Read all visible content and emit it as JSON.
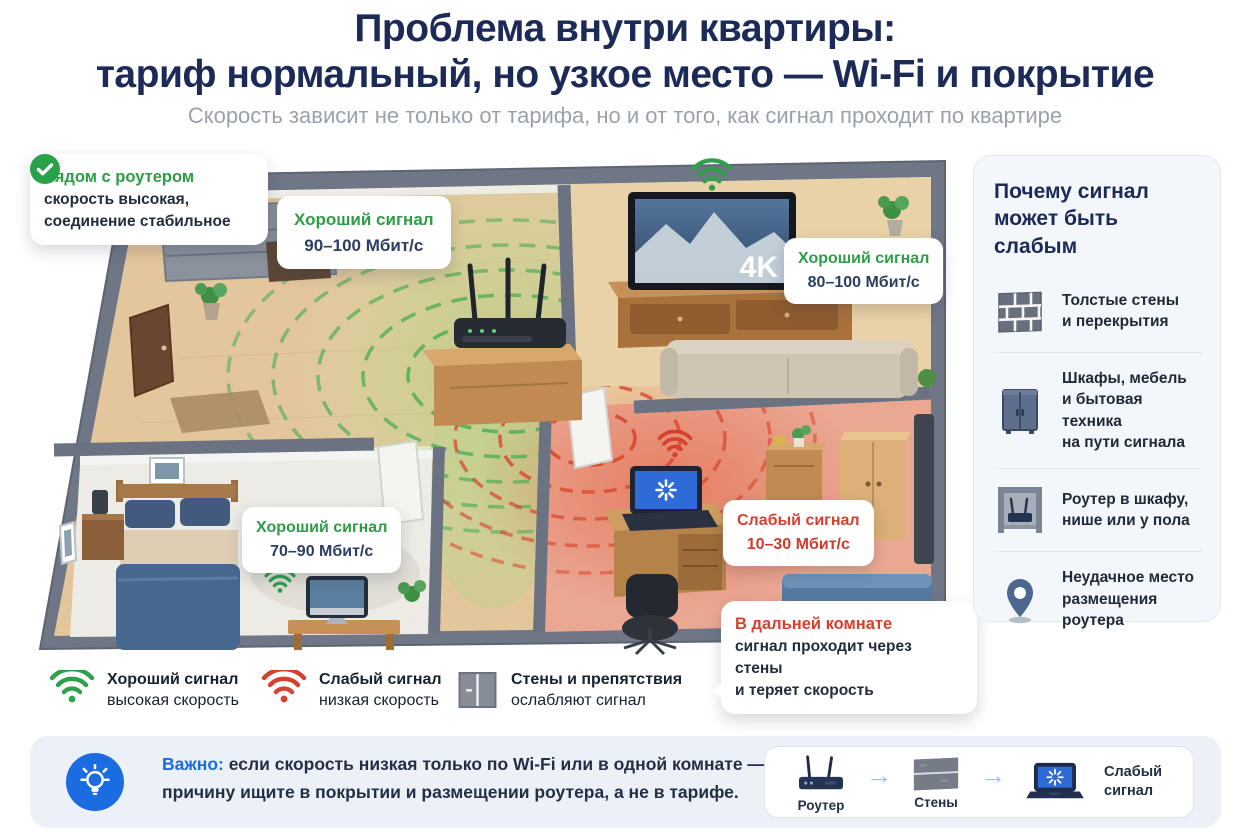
{
  "header": {
    "title_line1": "Проблема внутри квартиры:",
    "title_line2": "тариф нормальный, но узкое место — Wi-Fi и покрытие",
    "subtitle": "Скорость зависит не только от тарифа, но и от того, как сигнал проходит по квартире"
  },
  "plan": {
    "router_callout": {
      "title": "Рядом с роутером",
      "body": "скорость высокая,\nсоединение стабильное"
    },
    "signal_labels": [
      {
        "type": "good",
        "title": "Хороший сигнал",
        "value": "90–100 Мбит/с"
      },
      {
        "type": "good",
        "title": "Хороший сигнал",
        "value": "80–100 Мбит/с"
      },
      {
        "type": "good",
        "title": "Хороший сигнал",
        "value": "70–90 Мбит/с"
      },
      {
        "type": "bad",
        "title": "Слабый сигнал",
        "value": "10–30 Мбит/с"
      }
    ],
    "tv_badge": "4K",
    "far_room_callout": {
      "title": "В дальней комнате",
      "body": "сигнал проходит через стены\nи теряет скорость"
    }
  },
  "sidebar": {
    "title": "Почему сигнал\nможет быть слабым",
    "items": [
      {
        "icon": "brick-wall-icon",
        "text": "Толстые стены\nи перекрытия"
      },
      {
        "icon": "cabinet-icon",
        "text": "Шкафы, мебель\nи бытовая техника\nна пути сигнала"
      },
      {
        "icon": "router-in-niche-icon",
        "text": "Роутер в шкафу,\nнише или у пола"
      },
      {
        "icon": "location-pin-icon",
        "text": "Неудачное место\nразмещения роутера"
      }
    ]
  },
  "legend": [
    {
      "icon": "wifi-good-icon",
      "title": "Хороший сигнал",
      "subtitle": "высокая скорость"
    },
    {
      "icon": "wifi-weak-icon",
      "title": "Слабый сигнал",
      "subtitle": "низкая скорость"
    },
    {
      "icon": "wall-icon",
      "title": "Стены и препятствия",
      "subtitle": "ослабляют сигнал"
    }
  ],
  "note": {
    "label": "Важно:",
    "line1": "если скорость низкая только по Wi-Fi или в одной комнате —",
    "line2": "причину ищите в покрытии и размещении роутера, а не в тарифе.",
    "chain": [
      {
        "icon": "router-icon",
        "label": "Роутер"
      },
      {
        "icon": "wall-icon",
        "label": "Стены"
      },
      {
        "icon": "laptop-weak-icon",
        "label": "Слабый\nсигнал"
      }
    ]
  },
  "colors": {
    "navy": "#1c2a57",
    "good_green": "#2f9c47",
    "bad_red": "#d6402f",
    "accent_blue": "#1a6ce0",
    "subtitle_gray": "#99a1ae"
  }
}
